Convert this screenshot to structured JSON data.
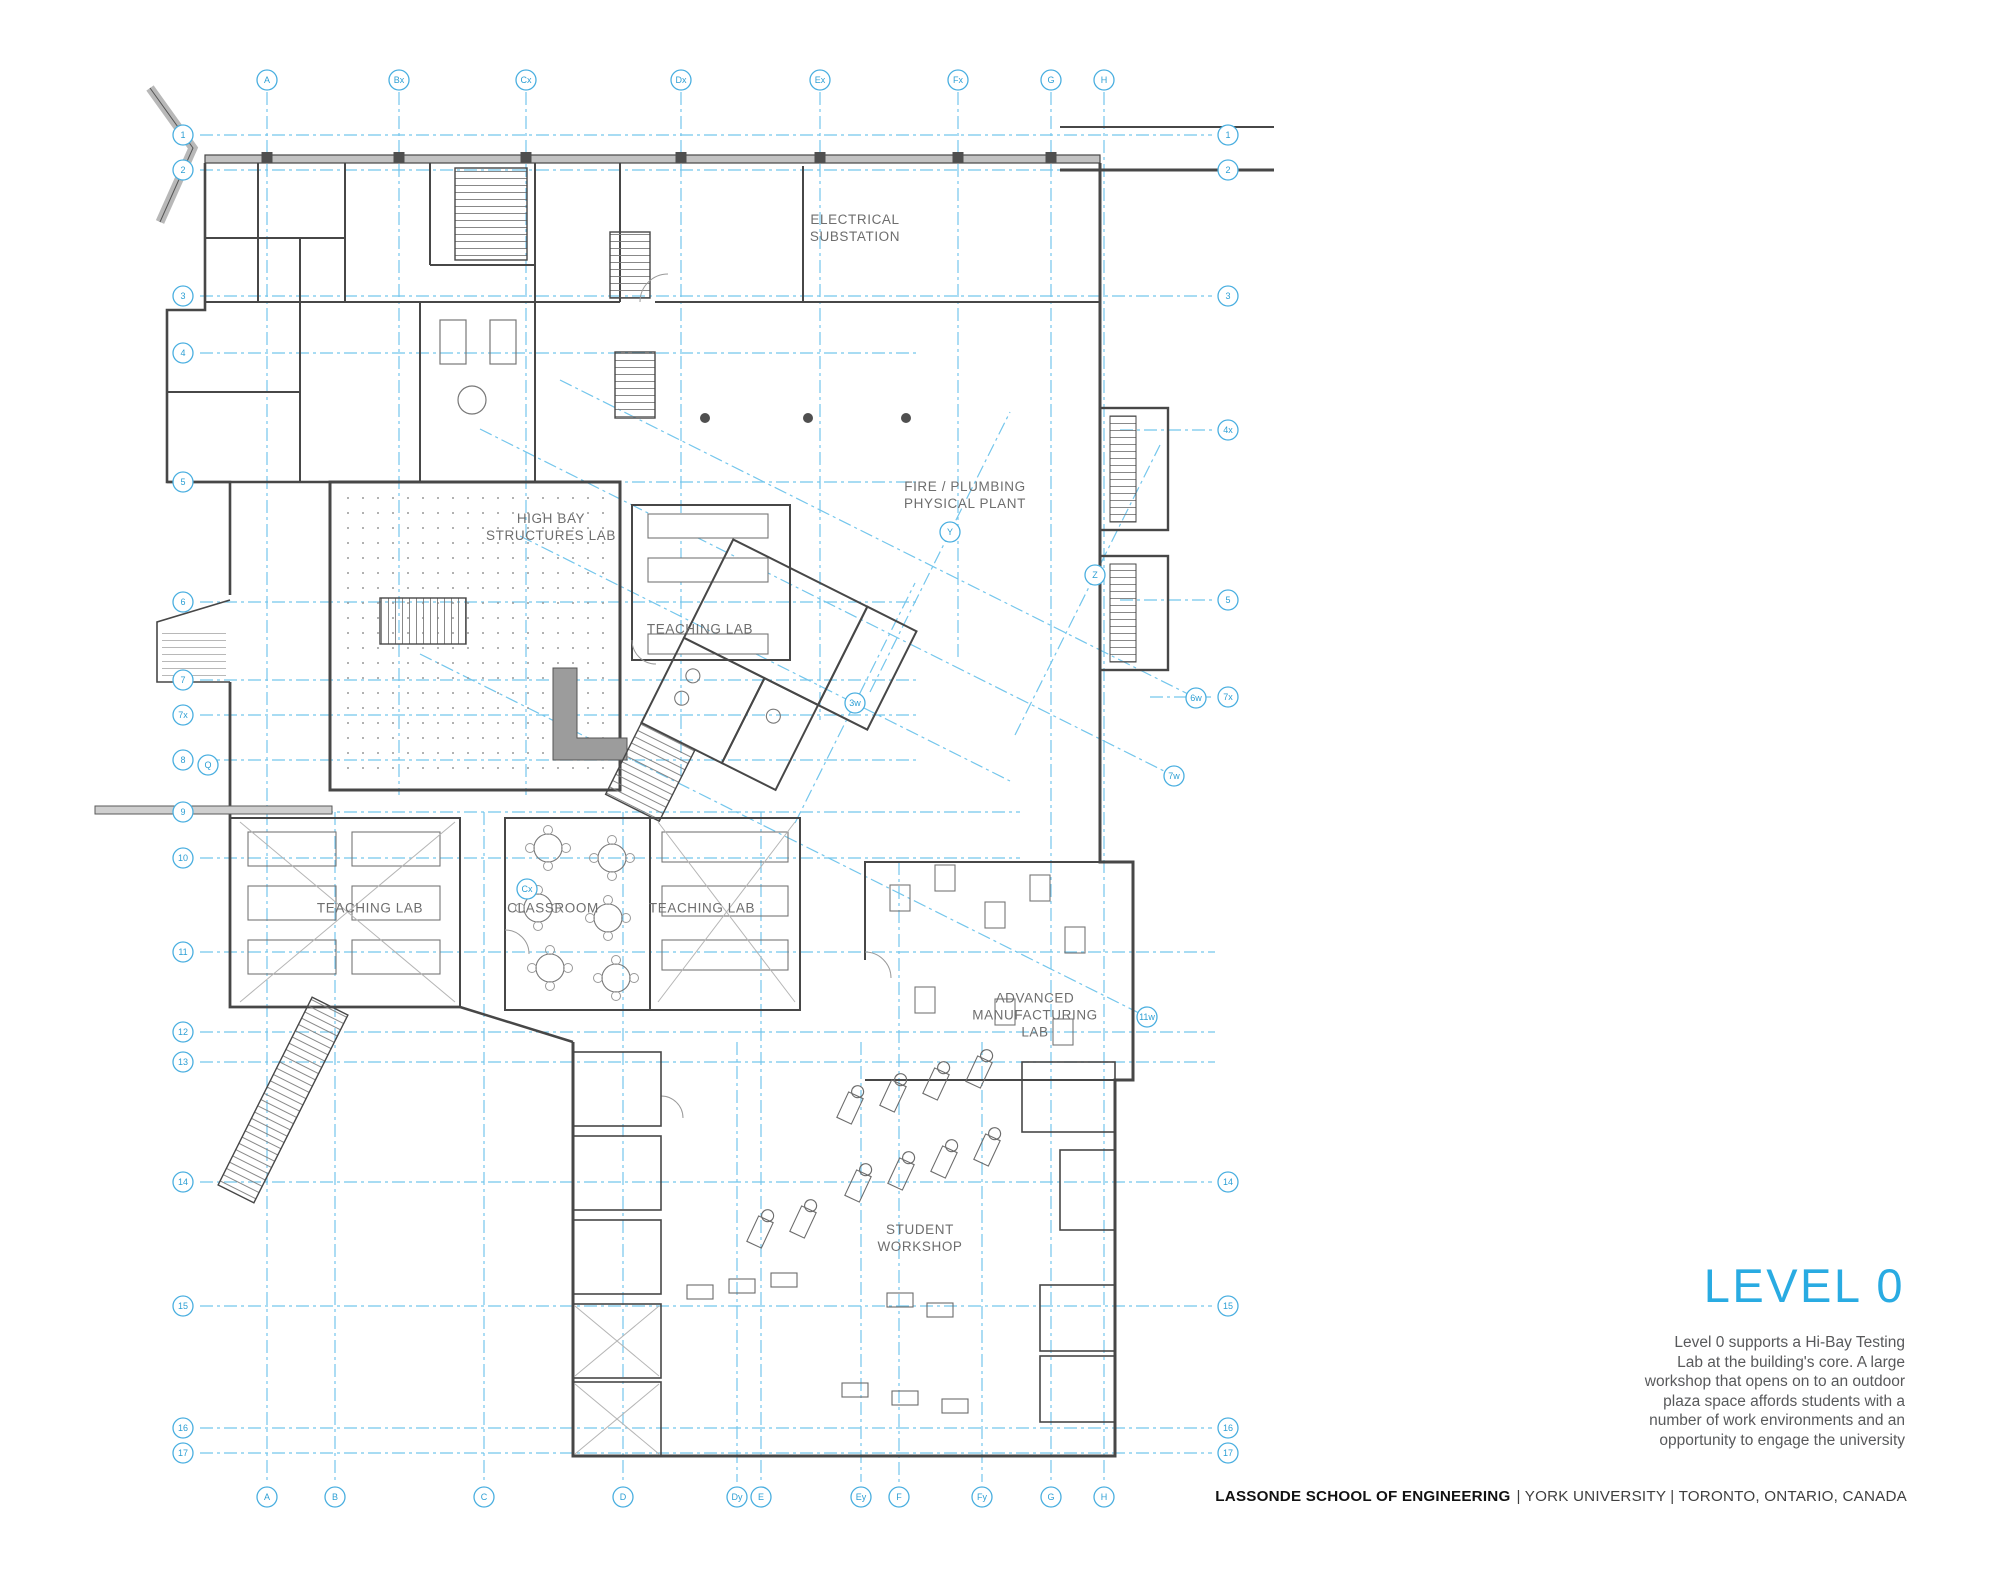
{
  "title": {
    "text": "LEVEL 0"
  },
  "description": "Level 0 supports a Hi-Bay Testing\nLab at the building's core. A large\nworkshop that opens on to an outdoor\nplaza space affords students with a\nnumber of work environments and an\nopportunity to engage the university",
  "footer": {
    "school": "LASSONDE SCHOOL OF ENGINEERING",
    "location": "| YORK UNIVERSITY | TORONTO, ONTARIO, CANADA"
  },
  "rooms": [
    {
      "label": "ELECTRICAL\nSUBSTATION",
      "x": 855,
      "y": 228
    },
    {
      "label": "FIRE / PLUMBING\nPHYSICAL PLANT",
      "x": 965,
      "y": 495
    },
    {
      "label": "HIGH BAY\nSTRUCTURES LAB",
      "x": 551,
      "y": 527
    },
    {
      "label": "TEACHING LAB",
      "x": 700,
      "y": 629
    },
    {
      "label": "TEACHING LAB",
      "x": 370,
      "y": 908
    },
    {
      "label": "CLASSROOM",
      "x": 553,
      "y": 908
    },
    {
      "label": "TEACHING LAB",
      "x": 702,
      "y": 908
    },
    {
      "label": "ADVANCED\nMANUFACTURING\nLAB",
      "x": 1035,
      "y": 1015
    },
    {
      "label": "STUDENT\nWORKSHOP",
      "x": 920,
      "y": 1238
    }
  ],
  "plan_grid": {
    "v_lines": [
      {
        "top": "A",
        "bottom": "A",
        "x": 267,
        "y1": 92,
        "y2": 1482
      },
      {
        "top": "Bx",
        "bottom": null,
        "x": 399,
        "y1": 92,
        "y2": 795
      },
      {
        "top": "Cx",
        "bottom": null,
        "x": 526,
        "y1": 92,
        "y2": 795
      },
      {
        "top": "Dx",
        "bottom": null,
        "x": 681,
        "y1": 92,
        "y2": 780
      },
      {
        "top": "Ex",
        "bottom": null,
        "x": 820,
        "y1": 92,
        "y2": 720
      },
      {
        "top": "Fx",
        "bottom": null,
        "x": 958,
        "y1": 92,
        "y2": 660
      },
      {
        "top": "G",
        "bottom": "G",
        "x": 1051,
        "y1": 92,
        "y2": 1482
      },
      {
        "top": "H",
        "bottom": "H",
        "x": 1104,
        "y1": 92,
        "y2": 1482
      },
      {
        "top": null,
        "bottom": "B",
        "x": 335,
        "y1": 812,
        "y2": 1482
      },
      {
        "top": null,
        "bottom": "C",
        "x": 484,
        "y1": 812,
        "y2": 1482
      },
      {
        "top": null,
        "bottom": "D",
        "x": 623,
        "y1": 812,
        "y2": 1482
      },
      {
        "top": null,
        "bottom": "Dy",
        "x": 737,
        "y1": 1042,
        "y2": 1482
      },
      {
        "top": null,
        "bottom": "E",
        "x": 761,
        "y1": 812,
        "y2": 1482
      },
      {
        "top": null,
        "bottom": "Ey",
        "x": 861,
        "y1": 1042,
        "y2": 1482
      },
      {
        "top": null,
        "bottom": "F",
        "x": 899,
        "y1": 862,
        "y2": 1482
      },
      {
        "top": null,
        "bottom": "Fy",
        "x": 982,
        "y1": 1042,
        "y2": 1482
      }
    ],
    "h_lines": [
      {
        "left": "1",
        "right": "1",
        "y": 135,
        "x1": 200,
        "x2": 1212
      },
      {
        "left": "2",
        "right": "2",
        "y": 170,
        "x1": 200,
        "x2": 1212
      },
      {
        "left": "3",
        "right": "3",
        "y": 296,
        "x1": 200,
        "x2": 1212
      },
      {
        "left": "4",
        "right": null,
        "y": 353,
        "x1": 200,
        "x2": 920
      },
      {
        "left": "5",
        "right": null,
        "y": 482,
        "x1": 200,
        "x2": 920
      },
      {
        "left": "6",
        "right": null,
        "y": 602,
        "x1": 200,
        "x2": 920
      },
      {
        "left": "7",
        "right": null,
        "y": 680,
        "x1": 200,
        "x2": 920
      },
      {
        "left": "7x",
        "right": null,
        "y": 715,
        "x1": 200,
        "x2": 920
      },
      {
        "left": "8",
        "right": null,
        "y": 760,
        "x1": 200,
        "x2": 920
      },
      {
        "left": "9",
        "right": null,
        "y": 812,
        "x1": 200,
        "x2": 1020
      },
      {
        "left": "10",
        "right": null,
        "y": 858,
        "x1": 200,
        "x2": 1020
      },
      {
        "left": "11",
        "right": null,
        "y": 952,
        "x1": 200,
        "x2": 1215
      },
      {
        "left": "12",
        "right": null,
        "y": 1032,
        "x1": 200,
        "x2": 1215
      },
      {
        "left": "13",
        "right": null,
        "y": 1062,
        "x1": 200,
        "x2": 1215
      },
      {
        "left": "14",
        "right": "14",
        "y": 1182,
        "x1": 200,
        "x2": 1212
      },
      {
        "left": "15",
        "right": "15",
        "y": 1306,
        "x1": 200,
        "x2": 1212
      },
      {
        "left": "16",
        "right": "16",
        "y": 1428,
        "x1": 200,
        "x2": 1212
      },
      {
        "left": "17",
        "right": "17",
        "y": 1453,
        "x1": 200,
        "x2": 1212
      },
      {
        "left": null,
        "right": "4x",
        "y": 430,
        "x1": 1120,
        "x2": 1212
      },
      {
        "left": null,
        "right": "5",
        "y": 600,
        "x1": 1120,
        "x2": 1212
      },
      {
        "left": null,
        "right": "7x",
        "y": 697,
        "x1": 1150,
        "x2": 1212
      }
    ],
    "diag_lines": [
      {
        "x1": 560,
        "y1": 380,
        "x2": 1196,
        "y2": 698,
        "end_label": "6w"
      },
      {
        "x1": 480,
        "y1": 429,
        "x2": 1174,
        "y2": 776,
        "end_label": "7w"
      },
      {
        "x1": 420,
        "y1": 654,
        "x2": 1147,
        "y2": 1017,
        "end_label": "11w"
      },
      {
        "x1": 520,
        "y1": 536,
        "x2": 1010,
        "y2": 781,
        "end_label": null
      },
      {
        "x1": 870,
        "y1": 692,
        "x2": 1010,
        "y2": 412,
        "end_label": null
      },
      {
        "x1": 1015,
        "y1": 735,
        "x2": 1160,
        "y2": 445,
        "end_label": null
      },
      {
        "x1": 795,
        "y1": 823,
        "x2": 915,
        "y2": 583,
        "end_label": null
      }
    ],
    "free_bubbles": [
      {
        "label": "Q",
        "x": 208,
        "y": 765
      },
      {
        "label": "Cx",
        "x": 527,
        "y": 889
      },
      {
        "label": "Y",
        "x": 950,
        "y": 532
      },
      {
        "label": "Z",
        "x": 1095,
        "y": 575
      },
      {
        "label": "3w",
        "x": 855,
        "y": 703
      }
    ]
  },
  "colors": {
    "accent_cyan": "#29abe2",
    "grid_blue": "#74c6ec",
    "bubble_blue": "#4aafe0",
    "wall_gray": "#474747",
    "room_label_gray": "#6e6e6e",
    "body_text_gray": "#58595b",
    "footer_black": "#111111"
  }
}
